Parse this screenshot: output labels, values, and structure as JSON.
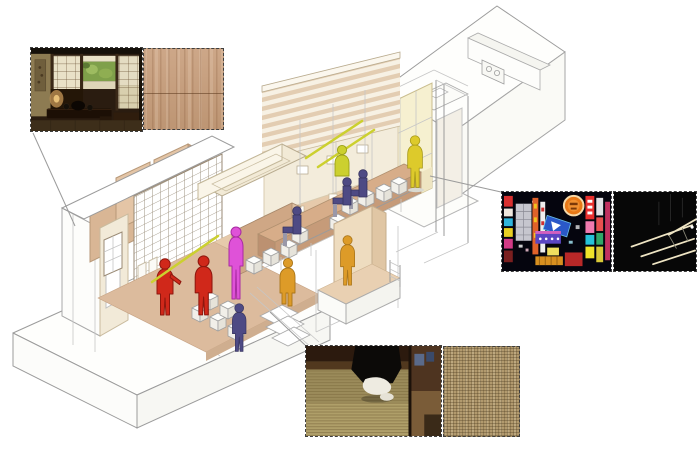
{
  "palette": {
    "canvas": "#ffffff",
    "figure-red": "#d0281a",
    "figure-red-dark": "#8e170e",
    "figure-magenta": "#df52d8",
    "figure-magenta-dark": "#a82ba2",
    "figure-navy": "#4e4a84",
    "figure-navy-dark": "#37345f",
    "figure-shin-gray": "#9a98a8",
    "figure-yellow": "#ddca2b",
    "figure-yellow-dark": "#a89a1a",
    "figure-chartreuse": "#ccd02f",
    "figure-chartreuse-dark": "#9aa018",
    "figure-orange": "#dd9b28",
    "figure-orange-dark": "#a9751a",
    "wall-tan": "#d9b695",
    "wall-cream": "#f2ead8",
    "floor-tan": "#dcbb9d",
    "counter-tan": "#d7ad89",
    "counter-front": "#c69b79",
    "accent-tube": "#ccd02f",
    "wireframe": "#9b9b9b",
    "wireframe-light": "#c6c6c6",
    "photo-border": "#3f3f3f"
  },
  "figures": [
    {
      "id": "person-red-1",
      "color": "figure-red",
      "pose": "standing, arm extended"
    },
    {
      "id": "person-red-2",
      "color": "figure-red",
      "pose": "standing"
    },
    {
      "id": "person-magenta",
      "color": "figure-magenta",
      "pose": "standing on step"
    },
    {
      "id": "person-navy-standing",
      "color": "figure-navy",
      "pose": "standing"
    },
    {
      "id": "person-navy-seated-1",
      "color": "figure-navy",
      "pose": "seated at counter"
    },
    {
      "id": "person-navy-seated-2",
      "color": "figure-navy",
      "pose": "seated at counter"
    },
    {
      "id": "person-navy-seated-3",
      "color": "figure-navy",
      "pose": "seated at counter"
    },
    {
      "id": "person-chartreuse-staff",
      "color": "figure-chartreuse",
      "pose": "standing behind counter"
    },
    {
      "id": "person-yellow-walking",
      "color": "figure-yellow",
      "pose": "walking through entrance"
    },
    {
      "id": "person-orange-seated-edge",
      "color": "figure-orange",
      "pose": "seated on platform edge"
    },
    {
      "id": "person-orange-standing",
      "color": "figure-orange",
      "pose": "standing in annex"
    }
  ],
  "reference_panels": [
    {
      "id": "japanese-interior-photo",
      "kind": "photo",
      "depicts": "traditional Japanese tatami room with shoji screens, garden window and low wooden table"
    },
    {
      "id": "wood-texture-swatch",
      "kind": "material",
      "depicts": "light oak wood grain"
    },
    {
      "id": "neon-signs-photo",
      "kind": "photo",
      "depicts": "night street with colorful stacked neon signboards"
    },
    {
      "id": "pendant-lights-photo",
      "kind": "photo",
      "depicts": "thin linear pendant light tubes against darkness"
    },
    {
      "id": "tatami-steps-photo",
      "kind": "photo",
      "depicts": "feet in white tabi socks stepping on tatami mat"
    },
    {
      "id": "burlap-texture-swatch",
      "kind": "material",
      "depicts": "woven burlap fabric"
    }
  ],
  "connectors": [
    {
      "from": "japanese-interior-photo",
      "to": "entry-room"
    },
    {
      "from": "entrance-vestibule",
      "to": "neon-signs-photo"
    },
    {
      "from": "tatami-annex",
      "to": "tatami-steps-photo"
    }
  ]
}
